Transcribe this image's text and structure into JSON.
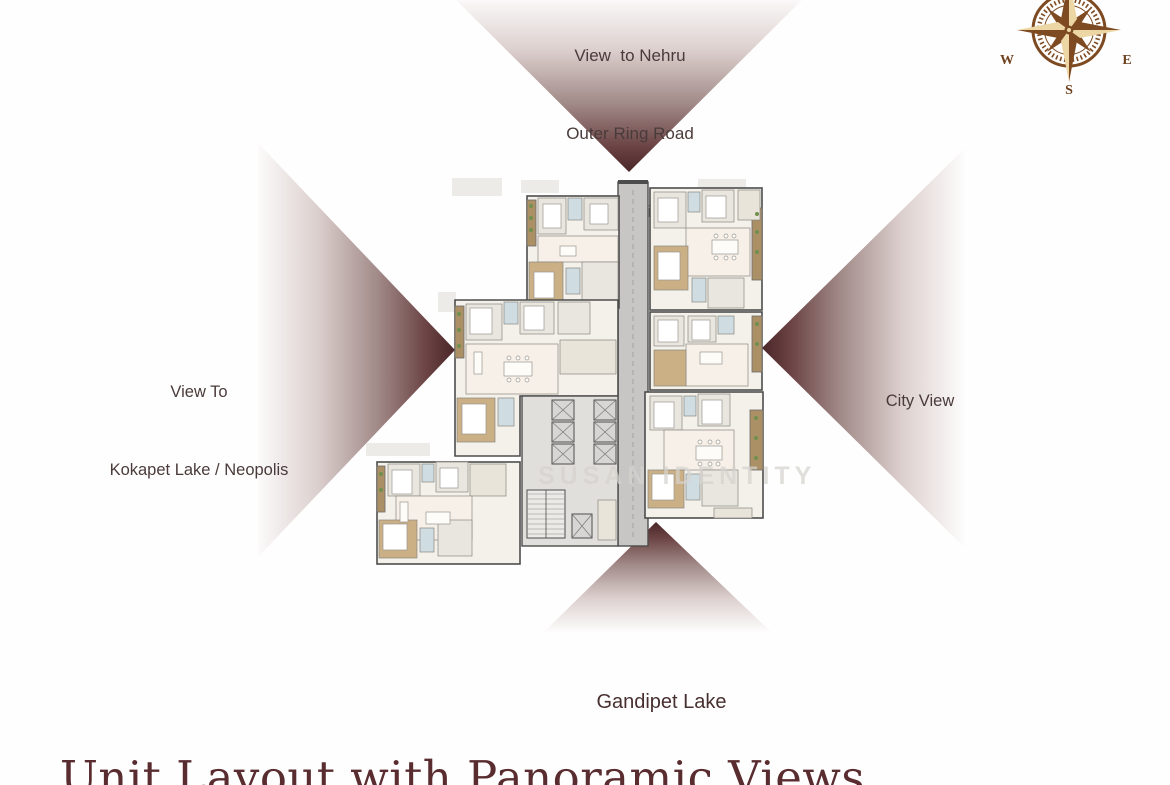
{
  "view_labels": {
    "top": {
      "line1": "View  to Nehru",
      "line2": "Outer Ring Road",
      "line3": "& City View"
    },
    "left": {
      "line1": "View To",
      "line2": "Kokapet Lake / Neopolis"
    },
    "right": {
      "line1": "City View"
    },
    "bottom": {
      "line1": "Gandipet Lake"
    }
  },
  "compass": {
    "west": "W",
    "east": "E",
    "south": "S"
  },
  "watermark": "SUSAN IDENTITY",
  "footer": {
    "title": "Unit Layout with Panoramic Views"
  },
  "colors": {
    "cone_dark": "#4a2628",
    "label_text": "#4a3b3b",
    "title_text": "#592c30",
    "compass_brown": "#7d4a21",
    "compass_cream": "#ecd7a4",
    "plan_wood": "#cbb086",
    "plan_bath": "#cfdde3",
    "plan_balcony": "#ab9066",
    "plan_corridor": "#c7c6c4"
  }
}
